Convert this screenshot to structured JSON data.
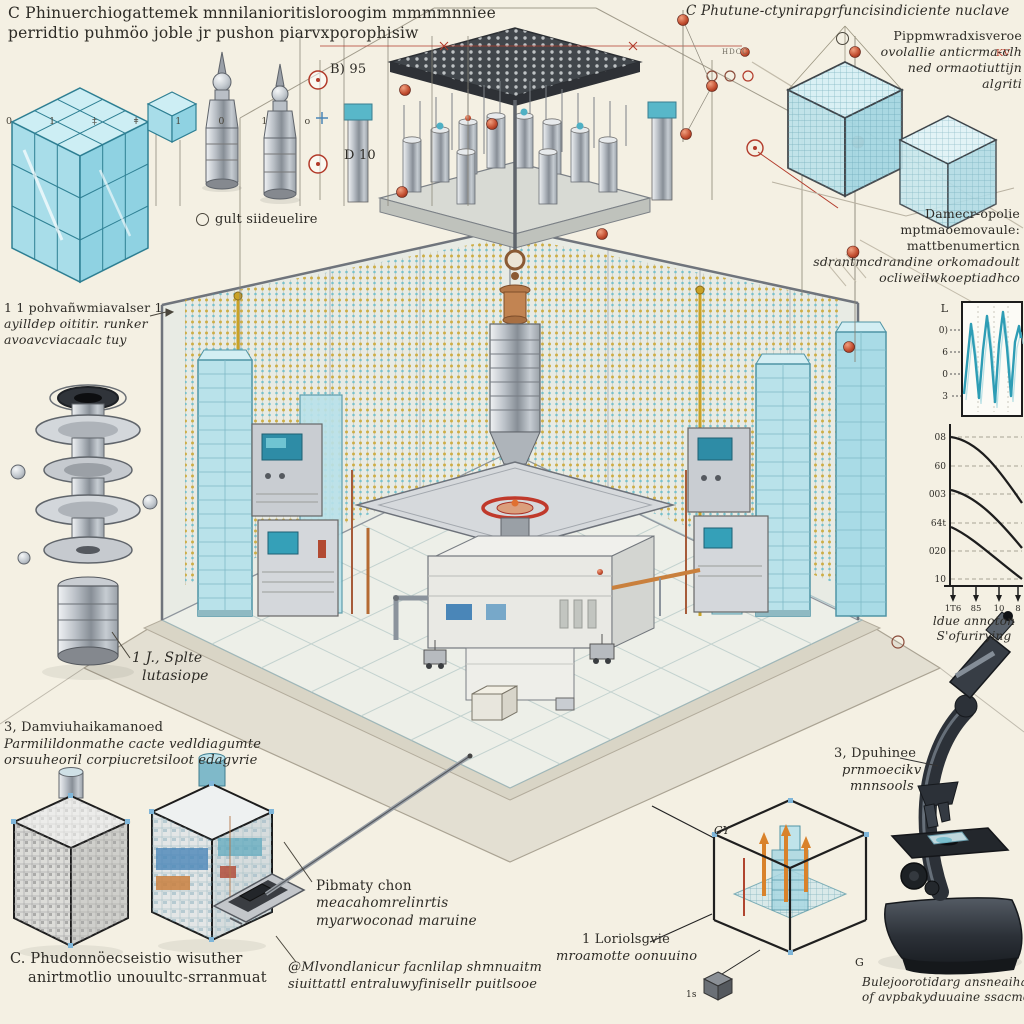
{
  "meta": {
    "description": "Isometric technical illustration of a nuclear research facility chamber with annotation labels, inset charts, sample cubes and a microscope",
    "colors": {
      "background": "#f4f0e3",
      "ink": "#2d2b26",
      "accent_red": "#b23a2a",
      "teal_glass": "#63b8c8",
      "gold_beads": "#c9a227",
      "metal_gray": "#9aa0a8",
      "frame_dark": "#1f1f1f"
    }
  },
  "annotations": {
    "top_left": {
      "lines": [
        "C Phinuerchiogattemek mnnilanioritisloroogim mmmmnniee",
        "perridtio puhmöo joble jr pushon piarvxporophisiw"
      ]
    },
    "ruler_glyphs": "0 1 ‡ ǂ 1 0 1 o",
    "drill_bullet_label": "gult siideuelire",
    "scale_marker_top": "B) 95",
    "scale_marker_bottom": "D 10",
    "hdcc": "HDCC",
    "kv": "KV",
    "left_panel": {
      "lines": [
        "1 1 pohvañwmiavalser 1",
        "ayilldep oititir. runker",
        "avoavcviacaalc tuy"
      ]
    },
    "spool": {
      "lines": [
        "1 J., Splte",
        "lutasiope"
      ]
    },
    "left_mid": {
      "lines": [
        "3, Damviuhaikamanoed",
        "Parmilildonmathe cacte vedldiagumte",
        "orsuuheoril corpiucretsiloot edagvrie"
      ]
    },
    "bottom_left": {
      "lines": [
        "C. Phudonnöecseistio wisuther",
        "anirtmotlio unouultc-srranmuat"
      ]
    },
    "top_right": {
      "title": "C Phutune-ctynirapgrfuncisindiciente nuclave",
      "bullets": [
        "Pippmwradxisveroe",
        "ovolallie anticrma-clh",
        "ned ormaotiuttijn",
        "algriti"
      ]
    },
    "right_block": {
      "lines": [
        "Damecr-opolie",
        "mptmaoemovaule:",
        "mattbenumerticn",
        "sdrantmcdrandine orkomadoult",
        "ocliweilwkoeptiadhco"
      ]
    },
    "chart_caption": {
      "lines": [
        "ldue annoton",
        "S'ofurirying"
      ]
    },
    "primary": {
      "lines": [
        "Pibmaty chon",
        "meacahomrelinrtis",
        "myarwoconad maruine"
      ]
    },
    "modular": {
      "lines": [
        "@Mlvondlanicur facnlilap shmnuaitm",
        "siuittattl entraluwyfinisellr puitlsooe"
      ]
    },
    "loriol": {
      "lines": [
        "1 Loriolsgvie",
        "mroamotte oonuuino"
      ]
    },
    "cube_cy": "CY",
    "cube_g": "G",
    "small_cube": "1s",
    "microscope": {
      "lines": [
        "3, Dpuhinee",
        "prnmoecikv",
        "mnnsools"
      ]
    },
    "bottom_right_caption": {
      "lines": [
        "Bulejoorotidarg ansneaihaw",
        "of avpbakyduuaine ssacmos"
      ]
    }
  },
  "charts": {
    "waveform": {
      "corner_label": "L",
      "yticks": [
        "0)",
        "6",
        "0",
        "3"
      ]
    },
    "decay": {
      "yticks": [
        "08",
        "60",
        "003",
        "64t",
        "020",
        "10"
      ],
      "xticks": [
        "1T6",
        "85",
        "10",
        "8"
      ]
    }
  },
  "chart_data": [
    {
      "type": "line",
      "title": "waveform inset",
      "y_tick_labels": [
        "0)",
        "6",
        "0",
        "3"
      ],
      "series": [
        {
          "name": "signal",
          "values": [
            0.25,
            0.8,
            0.95,
            0.45,
            0.05,
            0.65,
            0.97,
            0.5,
            0.02,
            0.72,
            1.0,
            0.55,
            0.08,
            0.78,
            0.88
          ]
        }
      ],
      "color": "#2e9db5",
      "grid": "faint-vertical-dashed"
    },
    {
      "type": "line",
      "title": "decay curves",
      "y_tick_labels": [
        "08",
        "60",
        "003",
        "64t",
        "020",
        "10"
      ],
      "x_tick_labels": [
        "1T6",
        "85",
        "10",
        "8"
      ],
      "series": [
        {
          "name": "curve-1",
          "values": [
            1.0,
            0.95,
            0.8,
            0.55,
            0.35
          ]
        },
        {
          "name": "curve-2",
          "values": [
            0.62,
            0.58,
            0.45,
            0.28,
            0.15
          ]
        },
        {
          "name": "curve-3",
          "values": [
            0.38,
            0.33,
            0.22,
            0.1,
            0.03
          ]
        }
      ],
      "grid": "dashed-horizontal",
      "legend": false,
      "caption": "ldue annoton S'ofurirying"
    }
  ]
}
